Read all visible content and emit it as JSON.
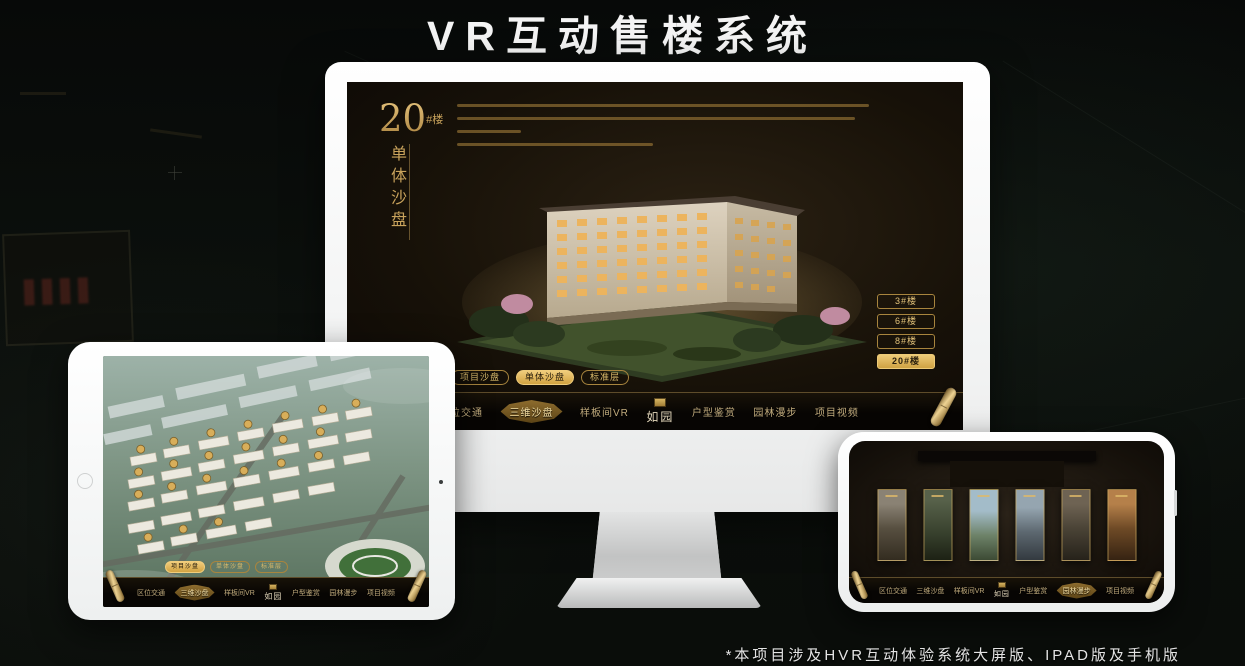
{
  "header": {
    "title": "VR互动售楼系统"
  },
  "footer": {
    "note": "*本项目涉及HVR互动体验系统大屏版、IPAD版及手机版"
  },
  "colors": {
    "gold": "#c9a35c",
    "gold_active": "#eecb78",
    "screen_bg": "#171108",
    "navbar_bg": "#0a0806",
    "frame_white": "#f4f5f5"
  },
  "sales_app": {
    "hero_number": "20",
    "hero_suffix": "#楼",
    "hero_subtitle": "单体沙盘",
    "floor_buttons": [
      "3#楼",
      "6#楼",
      "8#楼",
      "20#楼"
    ],
    "sub_tabs": [
      "项目沙盘",
      "单体沙盘",
      "标准层"
    ],
    "nav_items": [
      "区位交通",
      "三维沙盘",
      "样板间VR",
      "户型鉴赏",
      "园林漫步",
      "项目视频"
    ],
    "logo": "如园",
    "active_states": {
      "monitor_floor_button": "20#楼",
      "monitor_sub_tab": "单体沙盘",
      "monitor_nav_item": "三维沙盘",
      "tablet_sub_tab": "项目沙盘",
      "tablet_nav_item": "三维沙盘",
      "phone_nav_item": "园林漫步"
    }
  }
}
